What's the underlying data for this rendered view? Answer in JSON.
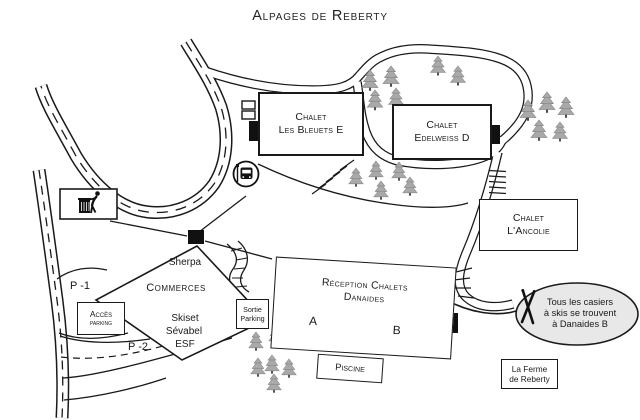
{
  "title": "Alpages de Reberty",
  "chalets": {
    "bleuets": {
      "name": "Chalet",
      "sub": "Les Bleuets E"
    },
    "edelweiss": {
      "name": "Chalet",
      "sub": "Edelweiss D"
    },
    "ancolie": {
      "name": "Chalet",
      "sub": "L'Ancolie"
    }
  },
  "commerces": {
    "banner": "Sherpa",
    "title": "Commerces",
    "shops": [
      "Skiset",
      "Sévabel",
      "ESF"
    ]
  },
  "reception": {
    "line1": "Réception Chalets",
    "line2": "Danaides",
    "wing_a": "A",
    "wing_b": "B"
  },
  "facilities": {
    "piscine": "Piscine",
    "ferme_line1": "La Ferme",
    "ferme_line2": "de Reberty"
  },
  "parking": {
    "acces_line1": "Accès",
    "acces_line2": "parking",
    "sortie_line1": "Sortie",
    "sortie_line2": "Parking",
    "level_1": "P -1",
    "level_2": "P -2"
  },
  "note": {
    "line1": "Tous les casiers",
    "line2": "à skis se trouvent",
    "line3": "à Danaides B"
  },
  "icons": {
    "trash": "trash-disposal-icon",
    "bus": "bus-stop-icon",
    "skis": "crossed-skis-icon",
    "trees": "fir-tree-icon"
  },
  "colors": {
    "line": "#1a1a1a",
    "note_fill": "#e8e8e8",
    "tree_fill": "#a9a9a9",
    "background": "#ffffff"
  }
}
